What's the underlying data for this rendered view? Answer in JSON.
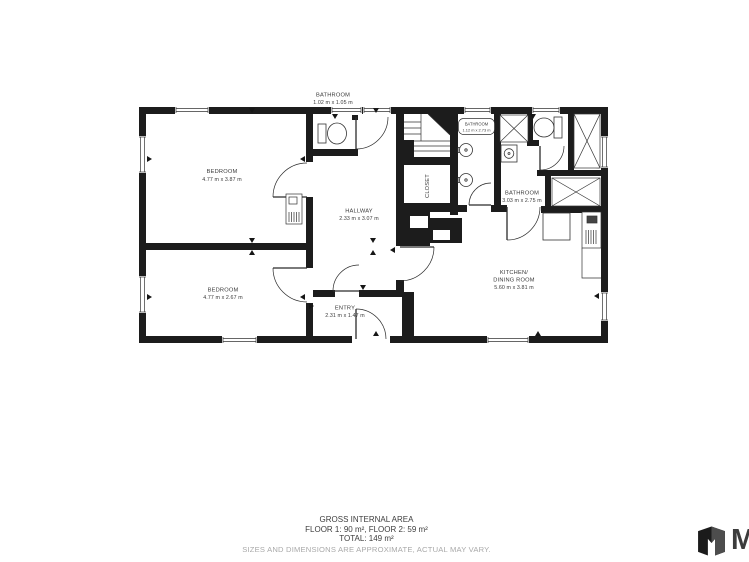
{
  "plan": {
    "rooms": [
      {
        "name": "BATHROOM",
        "dims": "1.02 m x 1.05 m"
      },
      {
        "name": "BEDROOM",
        "dims": "4.77 m x 3.87 m"
      },
      {
        "name": "BEDROOM",
        "dims": "4.77 m x 2.67 m"
      },
      {
        "name": "HALLWAY",
        "dims": "2.33 m x 3.07 m"
      },
      {
        "name": "ENTRY",
        "dims": "2.31 m x 1.47 m"
      },
      {
        "name": "CLOSET",
        "dims": ""
      },
      {
        "name": "BATHROOM",
        "dims": "1.12 m x 2.73 m"
      },
      {
        "name": "BATHROOM",
        "dims": "3.03 m x 2.75 m"
      },
      {
        "name": "KITCHEN/",
        "name2": "DINING ROOM",
        "dims": "5.60 m x 3.81 m"
      }
    ],
    "wall_color": "#1c1c1c"
  },
  "footer": {
    "title": "GROSS INTERNAL AREA",
    "floors": "FLOOR 1: 90 m², FLOOR 2: 59 m²",
    "total": "TOTAL: 149 m²",
    "disclaimer": "SIZES AND DIMENSIONS ARE APPROXIMATE, ACTUAL MAY VARY."
  },
  "branding": {
    "name": "Matterport",
    "visible_text": "Ma"
  }
}
